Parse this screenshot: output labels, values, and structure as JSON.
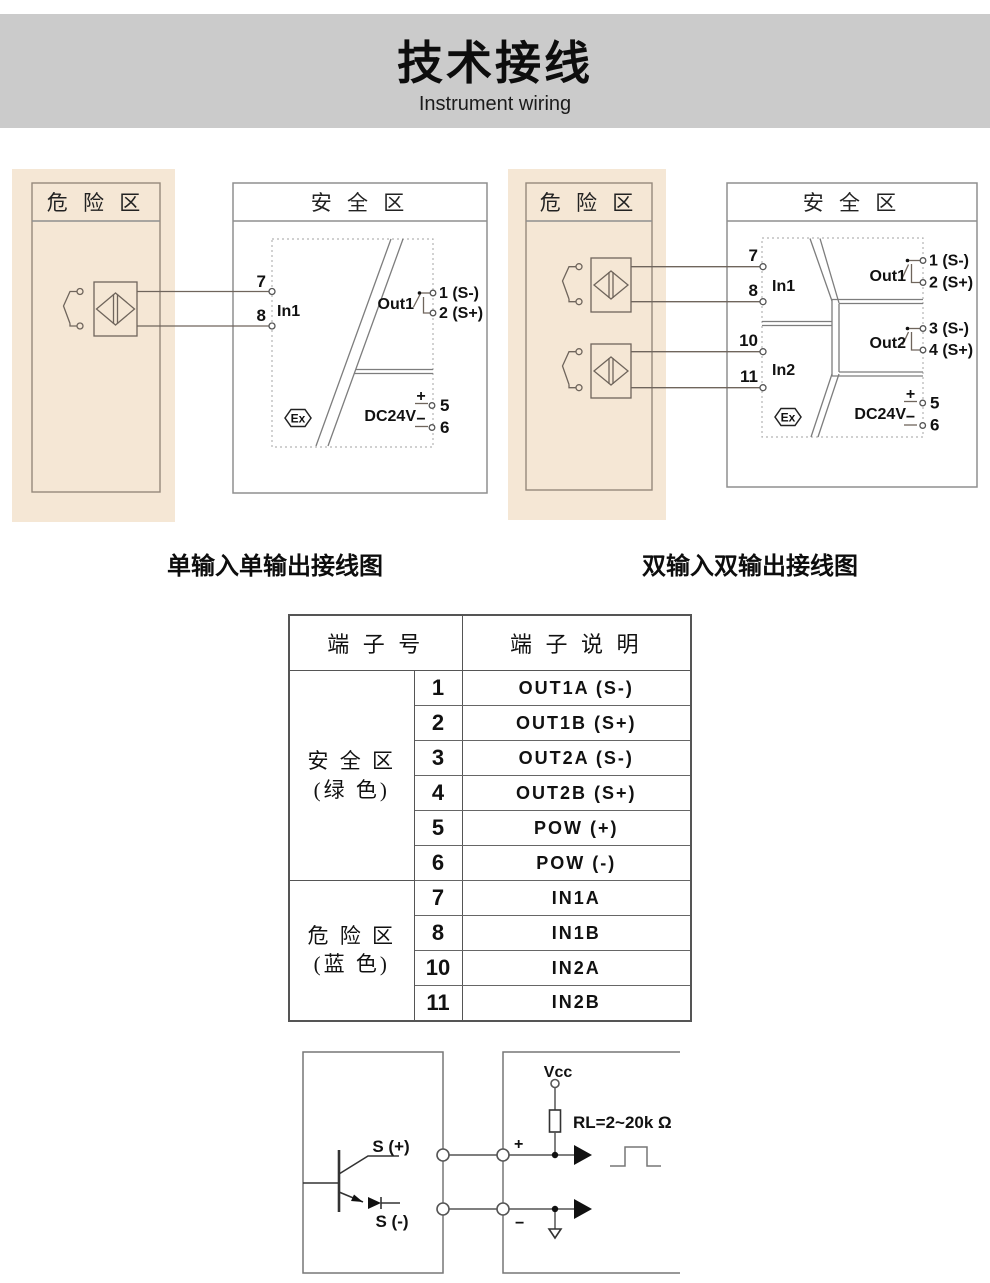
{
  "header": {
    "title": "技术接线",
    "subtitle": "Instrument wiring"
  },
  "colors": {
    "band": "#cbcbcb",
    "hazard_bg": "#f5e7d5",
    "line": "#6f655c"
  },
  "single_diagram": {
    "caption": "单输入单输出接线图",
    "hazard_title": "危 险 区",
    "safe_title": "安 全 区",
    "t7": "7",
    "t8": "8",
    "in1": "In1",
    "out1": "Out1",
    "o1": "1 (S-)",
    "o2": "2 (S+)",
    "plus": "+",
    "minus": "−",
    "p5": "5",
    "p6": "6",
    "dc24v": "DC24V",
    "ex": "Ex"
  },
  "dual_diagram": {
    "caption": "双输入双输出接线图",
    "hazard_title": "危 险 区",
    "safe_title": "安 全 区",
    "t7": "7",
    "t8": "8",
    "t10": "10",
    "t11": "11",
    "in1": "In1",
    "in2": "In2",
    "out1": "Out1",
    "out2": "Out2",
    "o1": "1 (S-)",
    "o2": "2 (S+)",
    "o3": "3 (S-)",
    "o4": "4 (S+)",
    "plus": "+",
    "minus": "−",
    "p5": "5",
    "p6": "6",
    "dc24v": "DC24V",
    "ex": "Ex"
  },
  "table": {
    "col_terminal": "端 子 号",
    "col_desc": "端 子 说 明",
    "groups": [
      {
        "zone": "安 全 区",
        "color_note": "(绿 色)",
        "rows": [
          {
            "num": "1",
            "desc": "OUT1A (S-)"
          },
          {
            "num": "2",
            "desc": "OUT1B (S+)"
          },
          {
            "num": "3",
            "desc": "OUT2A (S-)"
          },
          {
            "num": "4",
            "desc": "OUT2B (S+)"
          },
          {
            "num": "5",
            "desc": "POW (+)"
          },
          {
            "num": "6",
            "desc": "POW (-)"
          }
        ]
      },
      {
        "zone": "危 险 区",
        "color_note": "(蓝 色)",
        "rows": [
          {
            "num": "7",
            "desc": "IN1A"
          },
          {
            "num": "8",
            "desc": "IN1B"
          },
          {
            "num": "10",
            "desc": "IN2A"
          },
          {
            "num": "11",
            "desc": "IN2B"
          }
        ]
      }
    ]
  },
  "circuit": {
    "s_plus": "S (+)",
    "s_minus": "S (-)",
    "vcc": "Vcc",
    "rl": "RL=2~20k Ω",
    "plus": "+",
    "minus": "−"
  }
}
